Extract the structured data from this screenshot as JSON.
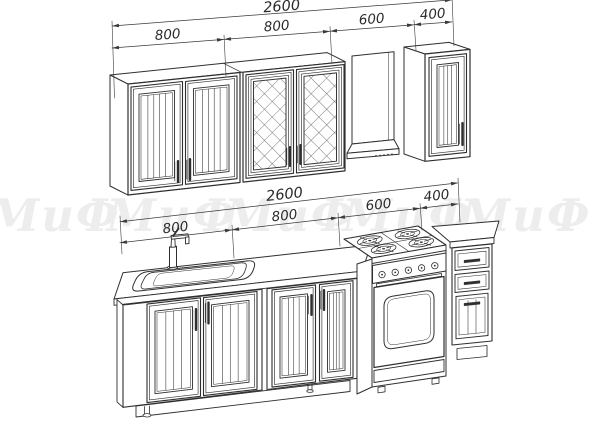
{
  "watermark": {
    "text": "МиФ"
  },
  "dimensions": {
    "top": {
      "overall": "2600",
      "segments": [
        "800",
        "800",
        "600",
        "400"
      ]
    },
    "bottom": {
      "overall": "2600",
      "segments": [
        "800",
        "800",
        "600",
        "400"
      ]
    }
  },
  "colors": {
    "line": "#2f2f2f",
    "dimension": "#3a3a3a",
    "watermark": "#ededed",
    "background": "#ffffff"
  }
}
